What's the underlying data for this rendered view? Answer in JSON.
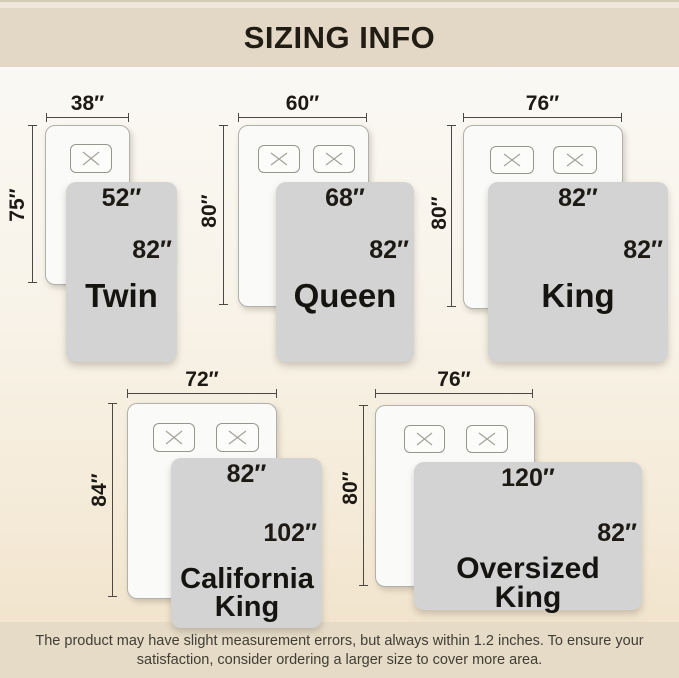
{
  "header": {
    "title": "SIZING INFO"
  },
  "sizes": [
    {
      "name": "Twin",
      "bed_width": "38″",
      "bed_length": "75″",
      "cover_width": "52″",
      "cover_length": "82″",
      "pillows": 1
    },
    {
      "name": "Queen",
      "bed_width": "60″",
      "bed_length": "80″",
      "cover_width": "68″",
      "cover_length": "82″",
      "pillows": 2
    },
    {
      "name": "King",
      "bed_width": "76″",
      "bed_length": "80″",
      "cover_width": "82″",
      "cover_length": "82″",
      "pillows": 2
    },
    {
      "name": "California King",
      "bed_width": "72″",
      "bed_length": "84″",
      "cover_width": "82″",
      "cover_length": "102″",
      "pillows": 2
    },
    {
      "name": "Oversized King",
      "bed_width": "76″",
      "bed_length": "80″",
      "cover_width": "120″",
      "cover_length": "82″",
      "pillows": 2
    }
  ],
  "footer": {
    "line1": "The product may have slight measurement errors, but always within 1.2 inches. To ensure your",
    "line2": "satisfaction, consider ordering a larger size to cover more area."
  },
  "colors": {
    "band": "#e3d8c5",
    "background_bottom": "#f0e1c8",
    "cover_gray": "#d2d3d2",
    "bed_white": "#fafaf8",
    "text": "#1d1a15"
  }
}
